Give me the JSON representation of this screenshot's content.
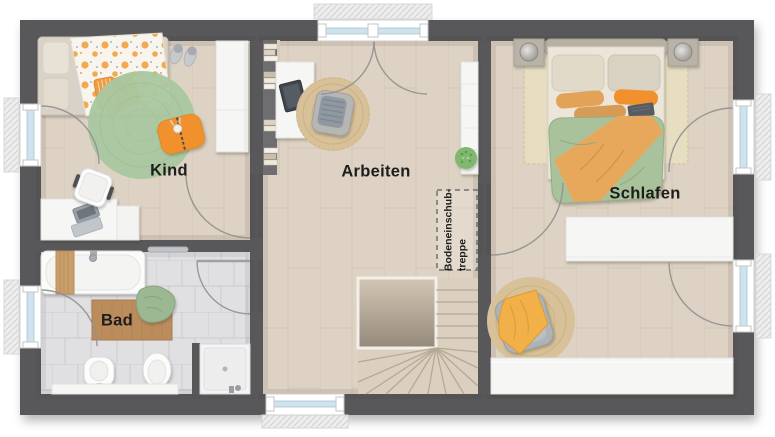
{
  "floorplan": {
    "rooms": [
      {
        "id": "kind",
        "label": "Kind"
      },
      {
        "id": "arbeiten",
        "label": "Arbeiten"
      },
      {
        "id": "schlafen",
        "label": "Schlafen"
      },
      {
        "id": "bad",
        "label": "Bad"
      }
    ],
    "annotations": {
      "attic_stairs_label_line1": "Bodeneinschub-",
      "attic_stairs_label_line2": "treppe"
    },
    "colors": {
      "wall": "#58585a",
      "wood_floor": "#ddd2c3",
      "wood_plank_line": "#c0b19c",
      "tile_floor": "#e0e0e3",
      "tile_line": "#cbccd1",
      "rug_green": "#a9c7a0",
      "rug_jute": "#d8c198",
      "bed_green": "#a9c29b",
      "bed_orange": "#e8a85c",
      "accent_orange": "#f0912f",
      "furniture_white": "#f6f6f5",
      "furniture_gray": "#b0b2b4",
      "window_glass": "#cfe3ef",
      "plant_green": "#7fb86e",
      "bath_mat_wood": "#bc8d5c",
      "stair_void_dark": "#94897b",
      "label_text": "#1d1d1d"
    }
  }
}
